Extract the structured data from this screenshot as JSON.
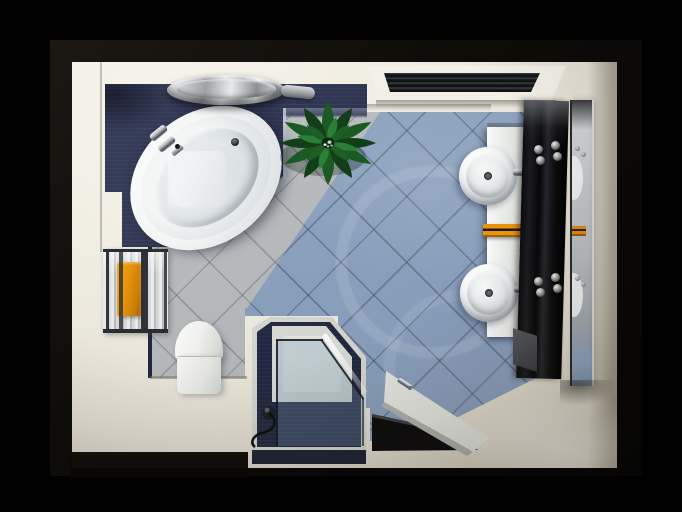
{
  "scene": {
    "render_style": "photorealistic 3D architectural render",
    "view": "top-down bird's-eye view",
    "subject": "modern bathroom interior floor plan",
    "description": "Top view of a modern bathroom framed by a black border: white oval corner bathtub on a dark navy platform with a chrome faucet and a round chrome cylinder, green leafy plant, ceiling vent grille, double vanity with two round white vessel sinks, chrome faucets, orange hand towels, glossy black wall panel with chrome control knobs and a mirror strip, ladder towel radiator with an orange towel, toilet, corner shower with navy walls, light tray and tinted glass enclosure with handset, open white door above a dark floor mat, diagonal blue-grey and grey floor tiles, cream walls and entry floor."
  },
  "objects": {
    "frame": {
      "label": "black frame border"
    },
    "room": {
      "label": "bathroom walls and cream floor"
    },
    "tile_floor_blue": {
      "label": "blue-grey diagonal tile floor"
    },
    "tile_floor_grey": {
      "label": "grey diagonal tile floor"
    },
    "platform": {
      "label": "navy bathtub platform"
    },
    "bathtub": {
      "label": "white oval corner bathtub"
    },
    "tub_faucet": {
      "label": "chrome bathtub faucet"
    },
    "tub_drain": {
      "label": "bathtub drain"
    },
    "chrome_cylinder": {
      "label": "round chrome cylinder"
    },
    "plant": {
      "label": "green leafy plant"
    },
    "vent": {
      "label": "ceiling vent grille"
    },
    "vanity_counter": {
      "label": "white vanity counter"
    },
    "sink_top": {
      "label": "round vessel sink (upper)"
    },
    "sink_bottom": {
      "label": "round vessel sink (lower)"
    },
    "sink_faucet_top": {
      "label": "chrome sink faucet (upper)"
    },
    "sink_faucet_bottom": {
      "label": "chrome sink faucet (lower)"
    },
    "hand_towels": {
      "label": "orange hand towels on rail"
    },
    "black_panel": {
      "label": "glossy black wall panel"
    },
    "controls_top": {
      "label": "chrome control knobs (upper)"
    },
    "controls_bottom": {
      "label": "chrome control knobs (lower)"
    },
    "mirror": {
      "label": "mirror strip with reflections"
    },
    "radiator": {
      "label": "ladder towel radiator"
    },
    "radiator_towel": {
      "label": "orange towel"
    },
    "toilet": {
      "label": "toilet"
    },
    "shower": {
      "label": "corner shower enclosure"
    },
    "shower_glass": {
      "label": "tinted shower glass panels"
    },
    "shower_handset": {
      "label": "shower handset with hose"
    },
    "door": {
      "label": "open white door"
    },
    "door_handle": {
      "label": "chrome door handle"
    },
    "door_mat": {
      "label": "dark floor mat"
    }
  },
  "palette": {
    "bg": "#000000",
    "frame": "#17120d",
    "wallBright": "#f6f3ea",
    "wallDark": "#c9c4b4",
    "navy": "#2e3550",
    "navyDark": "#1d2338",
    "navyEdge": "#141a2c",
    "tileBlue": "#8ba1bd",
    "tileGrey": "#b6b9bc",
    "tubWhite": "#f4f6f6",
    "chromeLight": "#f0f0f0",
    "chromeDark": "#50565c",
    "orange": "#e8940d",
    "orangeDark": "#a96605",
    "panelBlack": "#0a0a0c",
    "mirror": "#c2c6ca",
    "glass": "rgba(140,175,200,0.40)",
    "leafDark": "#144418",
    "leafMid": "#1c5a24",
    "leafLight": "#2b8038",
    "matBlack": "#0a0a0b",
    "trayLight": "#e3e5e2",
    "doorWhite": "#eef0ea"
  }
}
